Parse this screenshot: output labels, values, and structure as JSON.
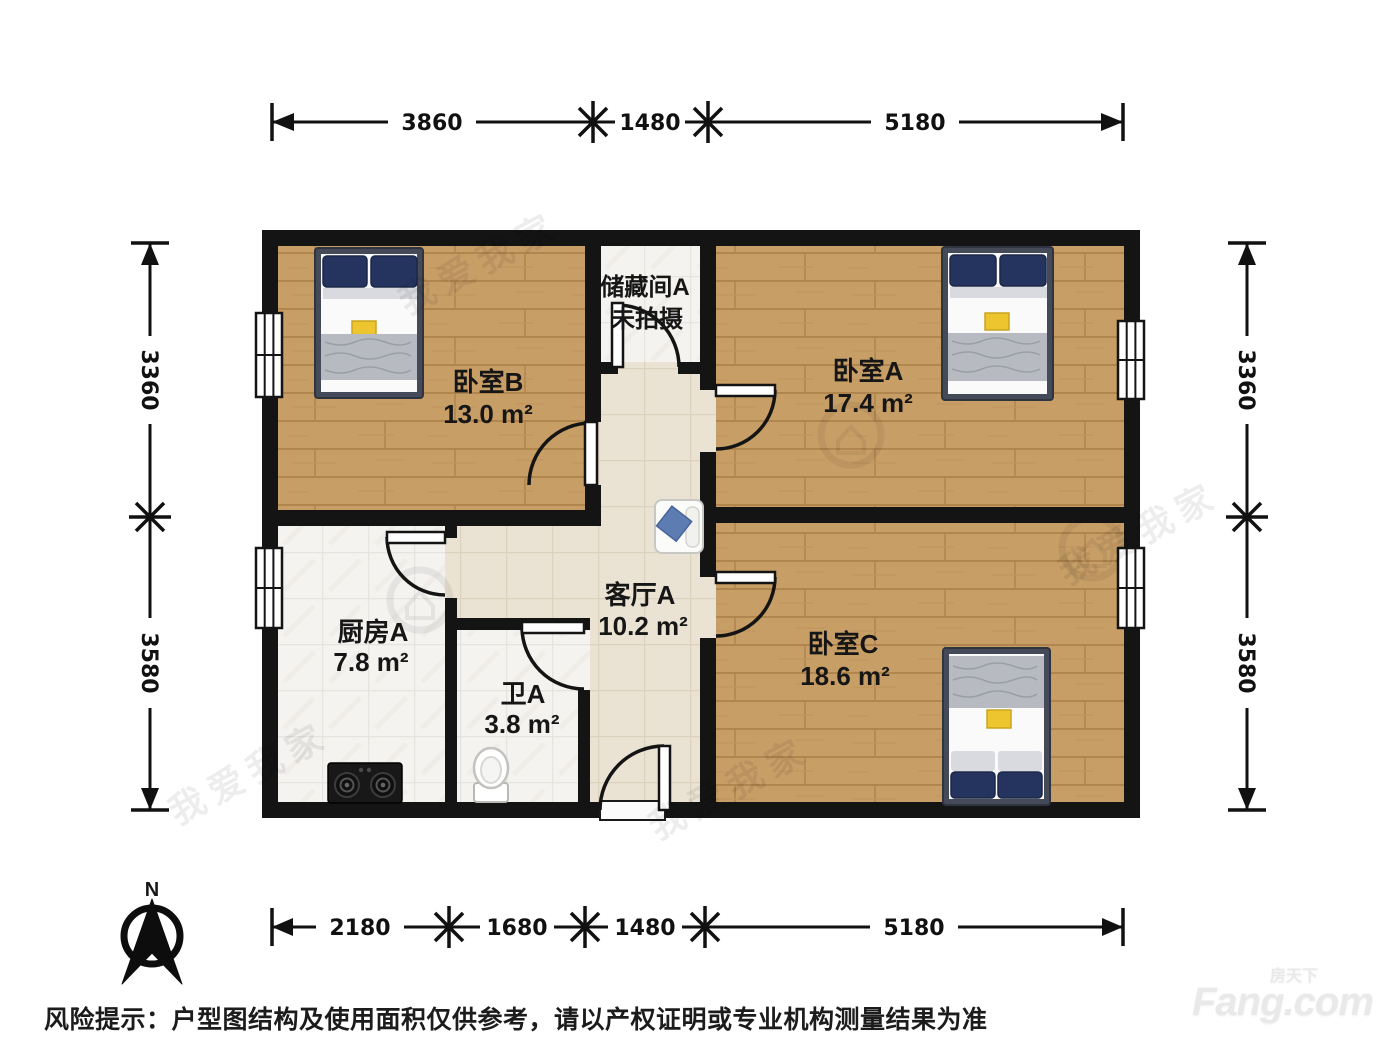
{
  "rooms": [
    {
      "id": "bedroom-b",
      "name": "卧室B",
      "area": "13.0 m²"
    },
    {
      "id": "bedroom-a",
      "name": "卧室A",
      "area": "17.4 m²"
    },
    {
      "id": "bedroom-c",
      "name": "卧室C",
      "area": "18.6 m²"
    },
    {
      "id": "kitchen",
      "name": "厨房A",
      "area": "7.8 m²"
    },
    {
      "id": "bathroom",
      "name": "卫A",
      "area": "3.8 m²"
    },
    {
      "id": "living",
      "name": "客厅A",
      "area": "10.2 m²"
    },
    {
      "id": "storage",
      "name": "储藏间A",
      "note": "未拍摄"
    }
  ],
  "dimensions": {
    "top": [
      "3860",
      "1480",
      "5180"
    ],
    "bottom": [
      "2180",
      "1680",
      "1480",
      "5180"
    ],
    "left": [
      "3360",
      "3580"
    ],
    "right": [
      "3360",
      "3580"
    ]
  },
  "compass": {
    "north_label": "N"
  },
  "watermark": {
    "text": "我爱我家"
  },
  "footer": {
    "disclaimer": "风险提示：户型图结构及使用面积仅供参考，请以产权证明或专业机构测量结果为准",
    "logo_cn": "房天下",
    "logo_en": "Fang.com"
  },
  "colors": {
    "wall": "#141414",
    "wood_floor": "#c89e67",
    "tile_floor": "#f4f3f0",
    "living_floor": "#eae3d3",
    "pillow_navy": "#25345f",
    "blanket_gray": "#b7bac0",
    "accent_yellow": "#edc52f"
  }
}
